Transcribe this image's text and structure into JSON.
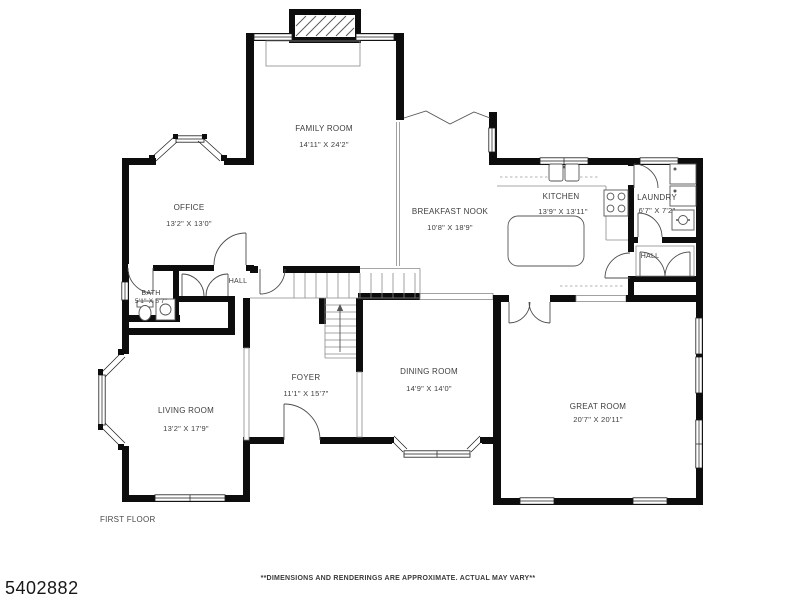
{
  "page": {
    "background": "#ffffff",
    "wall_color": "#0d0d0d",
    "label_color": "#3d3d3d"
  },
  "floorplan": {
    "floor_label": "FIRST FLOOR",
    "listing_number": "5402882",
    "disclaimer": "**DIMENSIONS AND RENDERINGS ARE APPROXIMATE. ACTUAL MAY VARY**",
    "rooms": [
      {
        "id": "family-room",
        "name": "FAMILY ROOM",
        "dims": "14'11\" X 24'2\""
      },
      {
        "id": "office",
        "name": "OFFICE",
        "dims": "13'2\" X 13'0\""
      },
      {
        "id": "breakfast-nook",
        "name": "BREAKFAST NOOK",
        "dims": "10'8\" X 18'9\""
      },
      {
        "id": "kitchen",
        "name": "KITCHEN",
        "dims": "13'9\" X 13'11\""
      },
      {
        "id": "laundry",
        "name": "LAUNDRY",
        "dims": "6'7\" X 7'2\""
      },
      {
        "id": "hall-upper",
        "name": "HALL",
        "dims": ""
      },
      {
        "id": "hall-lower",
        "name": "HALL",
        "dims": ""
      },
      {
        "id": "bath",
        "name": "BATH",
        "dims": "5'1\" X 5'7\""
      },
      {
        "id": "living-room",
        "name": "LIVING ROOM",
        "dims": "13'2\" X 17'9\""
      },
      {
        "id": "foyer",
        "name": "FOYER",
        "dims": "11'1\" X 15'7\""
      },
      {
        "id": "dining-room",
        "name": "DINING ROOM",
        "dims": "14'9\" X 14'0\""
      },
      {
        "id": "great-room",
        "name": "GREAT ROOM",
        "dims": "20'7\" X 20'11\""
      }
    ]
  }
}
